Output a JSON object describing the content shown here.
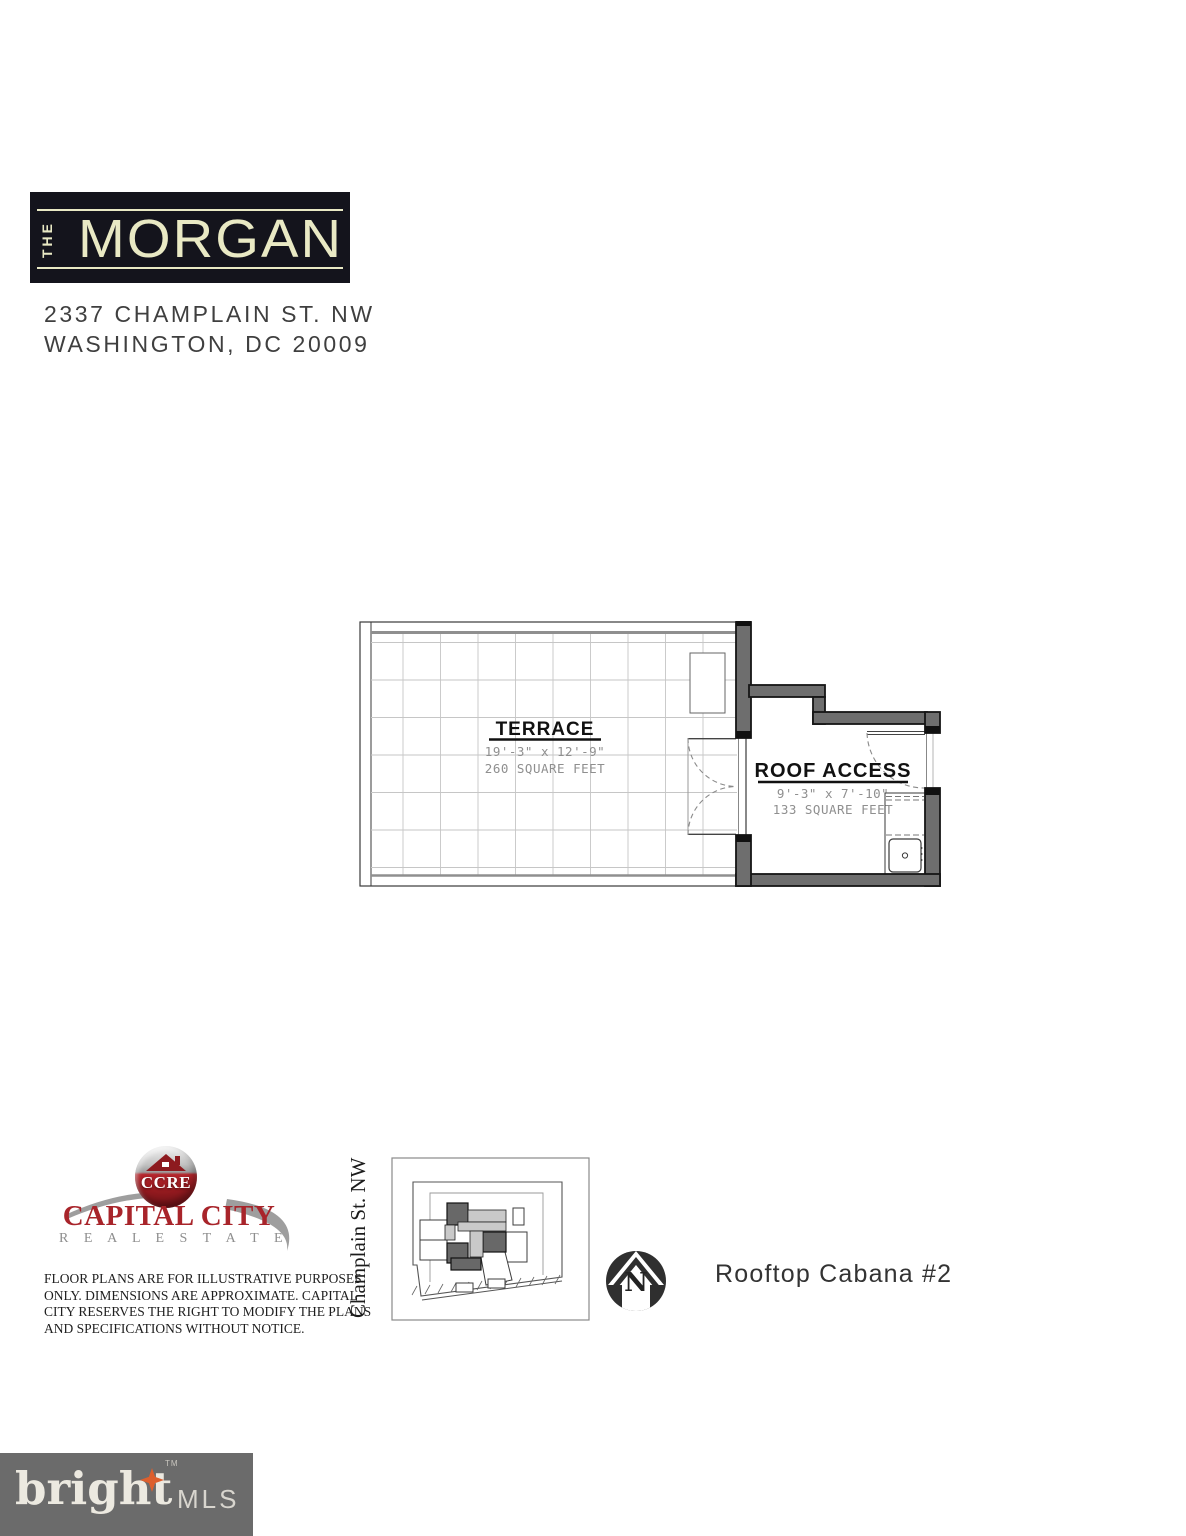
{
  "header": {
    "brand_prefix": "THE",
    "brand_name": "MORGAN",
    "address_line1": "2337 CHAMPLAIN ST. NW",
    "address_line2": "WASHINGTON, DC 20009"
  },
  "floor_plan": {
    "terrace": {
      "label": "TERRACE",
      "dimensions": "19'-3\" x 12'-9\"",
      "area": "260 SQUARE FEET"
    },
    "roof_access": {
      "label": "ROOF ACCESS",
      "dimensions": "9'-3\" x 7'-10\"",
      "area": "133 SQUARE FEET"
    }
  },
  "footer": {
    "brokerage": {
      "acronym": "CCRE",
      "name": "CAPITAL CITY",
      "subtitle": "R E A L   E S T A T E"
    },
    "disclaimer_lines": [
      "FLOOR PLANS ARE FOR ILLUSTRATIVE PURPOSES",
      "ONLY. DIMENSIONS ARE APPROXIMATE. CAPITAL",
      "CITY RESERVES THE RIGHT TO MODIFY THE PLANS",
      "AND SPECIFICATIONS WITHOUT NOTICE."
    ],
    "street_label": "Champlain St. NW",
    "compass_letter": "N",
    "unit_label": "Rooftop Cabana #2"
  },
  "mls": {
    "brand": "bright",
    "trademark": "TM",
    "suffix": "MLS"
  },
  "colors": {
    "brand_box": "#14141c",
    "brand_text": "#e9e9c4",
    "wall_gray": "#6e6e6e",
    "brokerage_red": "#a8242a",
    "mls_bg": "#6b6b6b",
    "mls_star": "#dd5f2d"
  }
}
